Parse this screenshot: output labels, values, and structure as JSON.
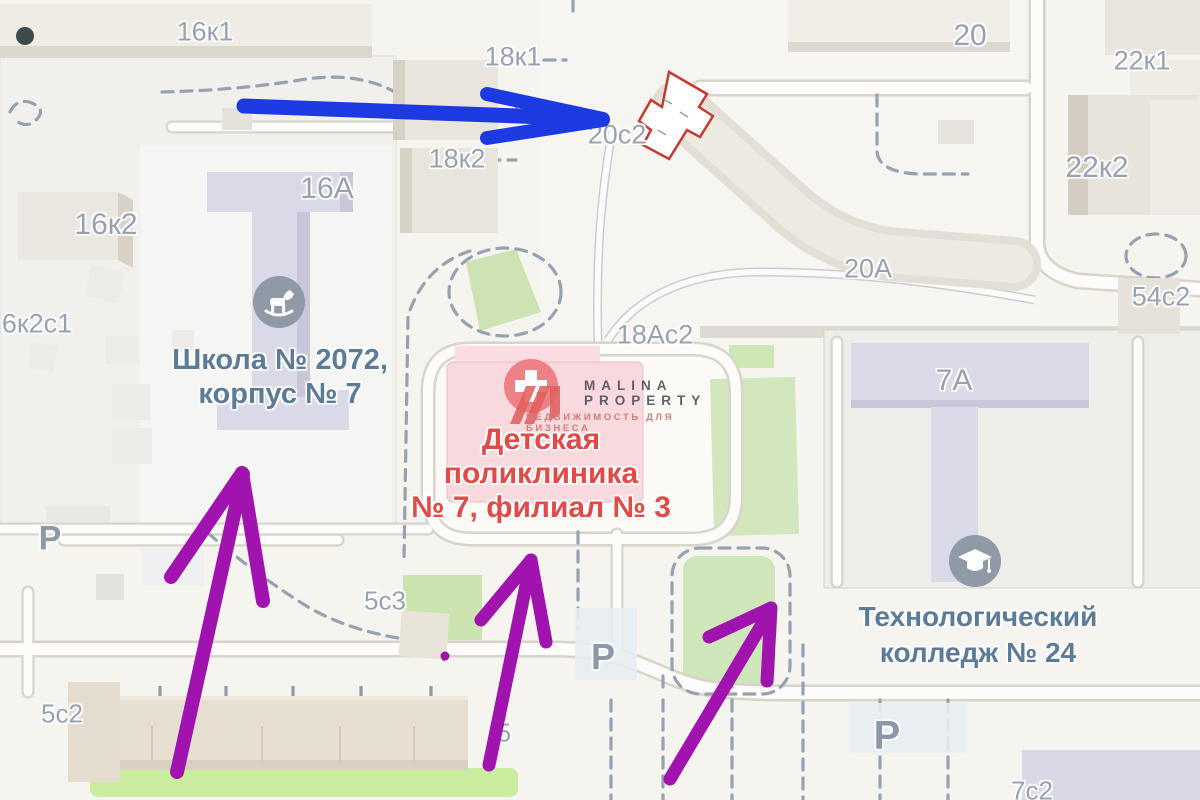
{
  "map_labels": {
    "b16k1": "16к1",
    "b18k1": "18к1",
    "b20": "20",
    "b22k1": "22к1",
    "b18k2": "18к2",
    "b20s2": "20с2",
    "b22k2": "22к2",
    "b16a": "16А",
    "b16k2": "16к2",
    "b6k2s1": "6к2с1",
    "b20a": "20А",
    "b54s2": "54с2",
    "b18as2": "18Ас2",
    "b7a": "7А",
    "b5s3": "5с3",
    "b5s2": "5с2",
    "b5": "5",
    "b7s2": "7с2"
  },
  "pois": {
    "school": {
      "line1": "Школа № 2072,",
      "line2": "корпус № 7"
    },
    "clinic": {
      "line1": "Детская",
      "line2": "поликлиника",
      "line3": "№ 7, филиал № 3"
    },
    "college": {
      "line1": "Технологический",
      "line2": "колледж № 24"
    }
  },
  "parking": {
    "label": "P"
  },
  "watermark": {
    "brand_line1": "MALINA",
    "brand_line2": "PROPERTY",
    "tagline": "НЕДВИЖИМОСТЬ ДЛЯ БИЗНЕСА"
  },
  "colors": {
    "blue_arrow": "#1d39e2",
    "purple_arrow": "#a013ae",
    "building_highlight": "#c5392e",
    "clinic_text": "#e04a47",
    "poi_text": "#5c7b97",
    "number_text": "#99a1b1",
    "parking_text": "#8d98a8",
    "green_area": "#cfe6b8",
    "building_beige": "#eae6dd",
    "building_lavender": "#d9d9e8"
  },
  "icons": {
    "school": "rocking-horse-icon",
    "college": "graduation-cap-icon",
    "clinic": "medical-cross-icon",
    "marker": "entrance-dot"
  }
}
